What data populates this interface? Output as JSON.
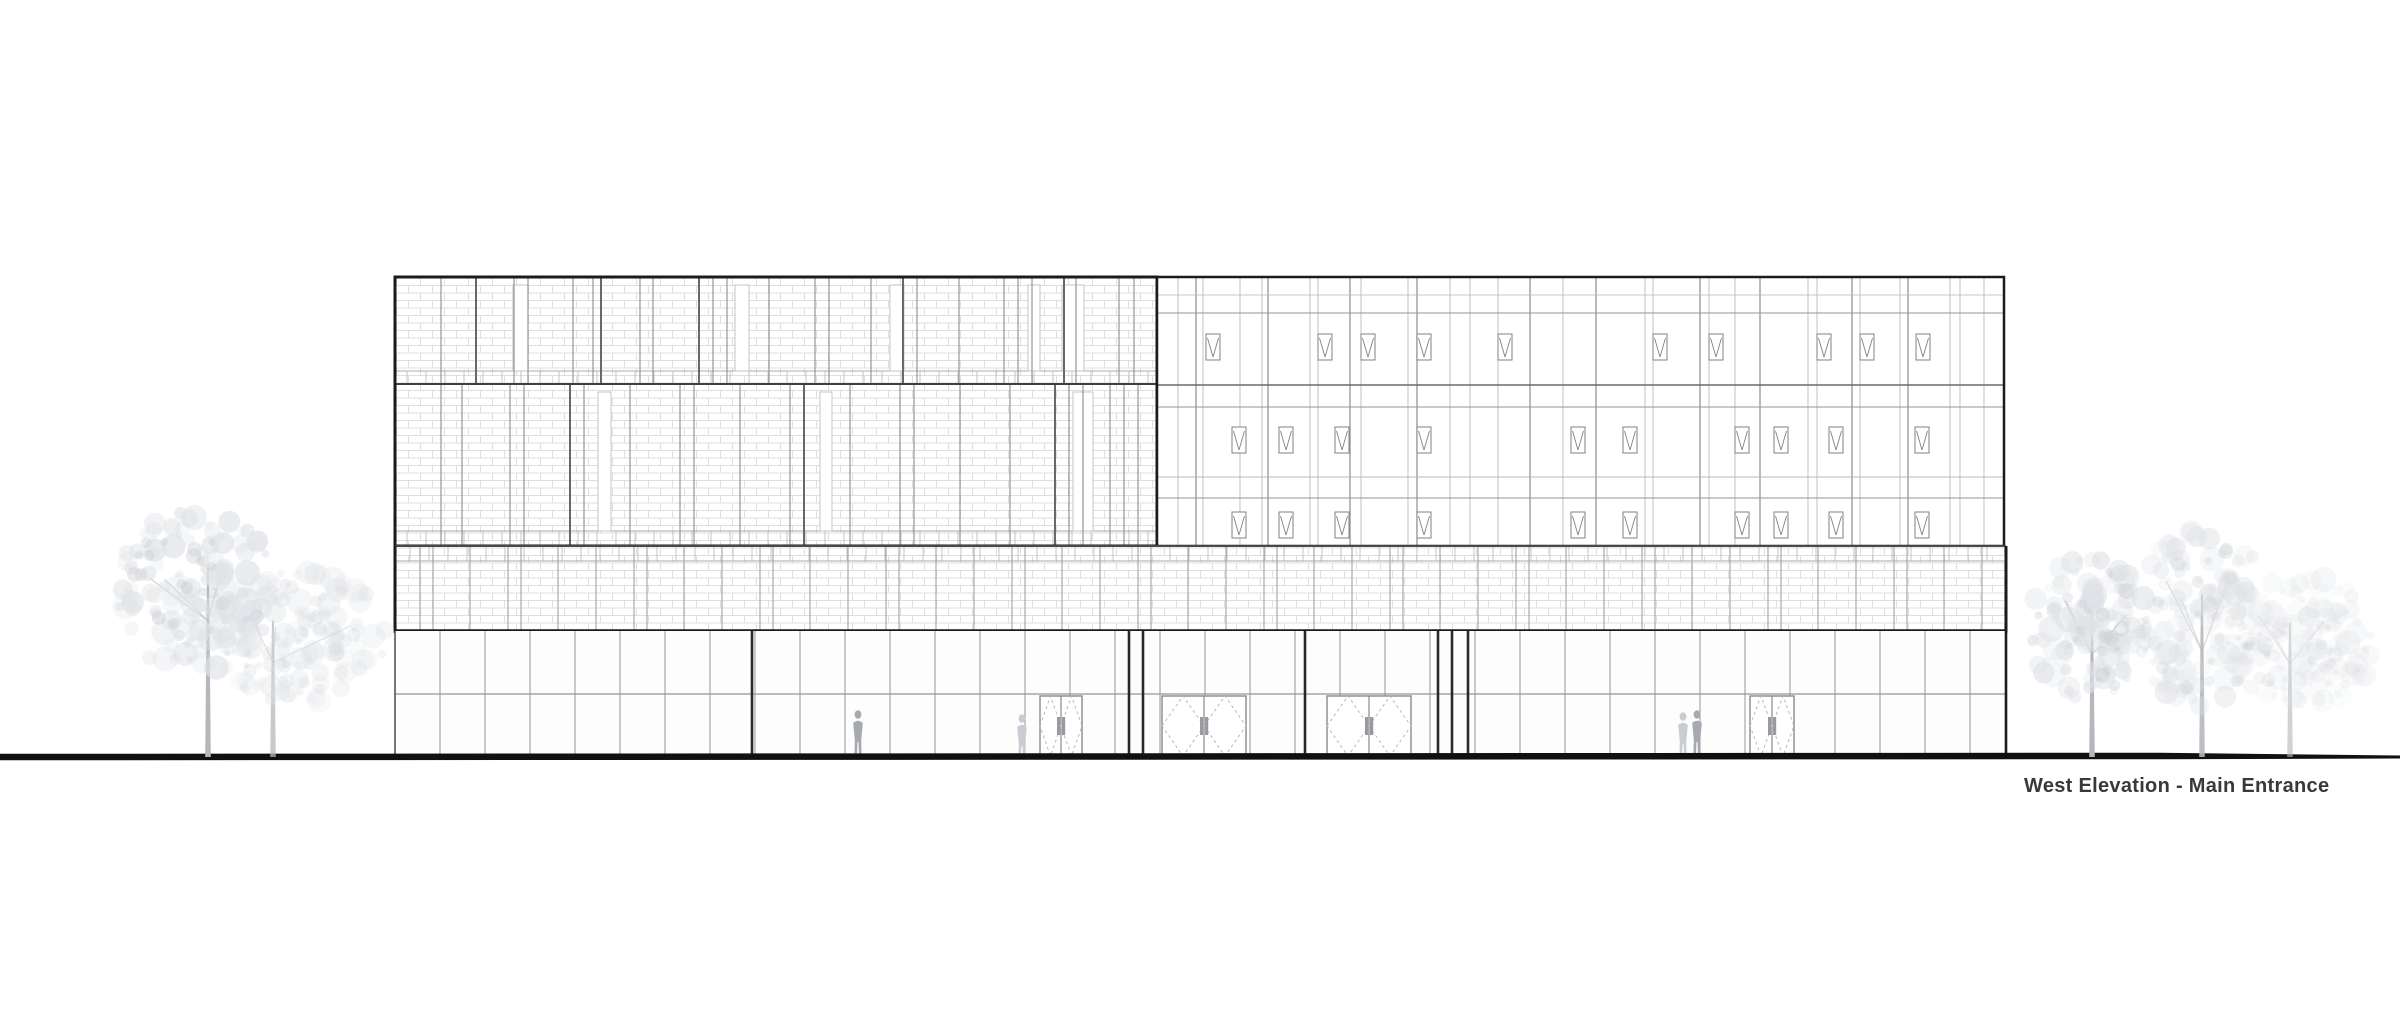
{
  "drawing": {
    "label": "West Elevation - Main Entrance"
  },
  "colors": {
    "background": "#ffffff",
    "outline": "#1b1b1d",
    "outline_medium": "#48484a",
    "mullion_dark": "#68686b",
    "mullion_mid": "#95959a",
    "mullion_light": "#b9b9bc",
    "brick_line": "#dfdfe2",
    "panel_fill": "#ffffff",
    "ground_line": "#101010",
    "label_text": "#39393b",
    "tree_foliage": "#dfe2e6",
    "tree_foliage_dark": "#c7cbd0",
    "tree_trunk": "#b4b7bc",
    "person_dark": "#a6aaaf",
    "person_light": "#c9cdd1"
  },
  "building": {
    "top": 277,
    "ground_y": 757,
    "left_block": {
      "x1": 395,
      "x2": 1157,
      "bands": [
        {
          "y1": 277,
          "y2": 384,
          "substrip_y": 371,
          "mullions": [
            441,
            476,
            514,
            528,
            573,
            593,
            601,
            640,
            653,
            699,
            713,
            727,
            769,
            815,
            829,
            871,
            903,
            917,
            959,
            1004,
            1018,
            1032,
            1064,
            1076,
            1119,
            1134
          ],
          "heavy": [
            476,
            601,
            699,
            903,
            1064
          ],
          "slots": [
            {
              "x": 513,
              "w": 15
            },
            {
              "x": 735,
              "w": 14
            },
            {
              "x": 890,
              "w": 14
            },
            {
              "x": 1028,
              "w": 12
            },
            {
              "x": 1062,
              "w": 22
            }
          ]
        },
        {
          "y1": 384,
          "y2": 546,
          "substrip_y": 531,
          "mullions": [
            441,
            462,
            510,
            524,
            570,
            584,
            630,
            680,
            694,
            740,
            790,
            804,
            850,
            900,
            914,
            960,
            1010,
            1055,
            1069,
            1083,
            1110,
            1124,
            1138
          ],
          "heavy": [
            570,
            804,
            1055
          ],
          "slots": [
            {
              "x": 598,
              "w": 13
            },
            {
              "x": 820,
              "w": 12
            },
            {
              "x": 1073,
              "w": 20
            }
          ]
        }
      ]
    },
    "right_block": {
      "x1": 1157,
      "x2": 2004,
      "rows": [
        {
          "y": 295,
          "w": 0.8,
          "tone": "light"
        },
        {
          "y": 313,
          "w": 1.0,
          "tone": "mid"
        },
        {
          "y": 385,
          "w": 1.6,
          "tone": "dark"
        },
        {
          "y": 407,
          "w": 1.0,
          "tone": "mid"
        },
        {
          "y": 477,
          "w": 0.9,
          "tone": "light"
        },
        {
          "y": 498,
          "w": 1.0,
          "tone": "mid"
        }
      ],
      "verticals": [
        1178,
        1196,
        1203,
        1240,
        1262,
        1268,
        1310,
        1318,
        1350,
        1361,
        1408,
        1417,
        1450,
        1470,
        1498,
        1530,
        1563,
        1596,
        1645,
        1653,
        1700,
        1709,
        1735,
        1760,
        1808,
        1817,
        1852,
        1860,
        1900,
        1908,
        1950,
        1960,
        1984
      ],
      "verticals_dark": [
        1196,
        1268,
        1350,
        1417,
        1530,
        1596,
        1700,
        1760,
        1852,
        1908
      ],
      "vent_w": 14,
      "vent_h": 26,
      "vent_rows": [
        {
          "y": 334,
          "xs": [
            1206,
            1318,
            1361,
            1417,
            1498,
            1653,
            1709,
            1817,
            1860,
            1916
          ]
        },
        {
          "y": 427,
          "xs": [
            1232,
            1279,
            1335,
            1417,
            1571,
            1623,
            1735,
            1774,
            1829,
            1915
          ]
        },
        {
          "y": 512,
          "xs": [
            1232,
            1279,
            1335,
            1417,
            1571,
            1623,
            1735,
            1774,
            1829,
            1915
          ]
        }
      ]
    },
    "mid_band": {
      "x1": 395,
      "x2": 2006,
      "y1": 546,
      "y2": 631,
      "strip_y": 561,
      "joints": [
        420,
        433,
        470,
        508,
        521,
        558,
        596,
        634,
        647,
        684,
        722,
        760,
        773,
        810,
        848,
        886,
        899,
        936,
        974,
        1012,
        1025,
        1062,
        1100,
        1138,
        1151,
        1188,
        1226,
        1264,
        1277,
        1314,
        1352,
        1390,
        1403,
        1440,
        1478,
        1516,
        1529,
        1566,
        1604,
        1642,
        1655,
        1692,
        1730,
        1768,
        1781,
        1818,
        1856,
        1894,
        1907,
        1944,
        1982
      ]
    },
    "ground_floor": {
      "x1": 395,
      "x2": 2006,
      "y1": 631,
      "y2": 757,
      "transom_y": 694,
      "mullion_spacing": 45,
      "heavy_x": [
        752,
        1129,
        1143,
        1305,
        1438,
        1452,
        1468
      ],
      "doors": [
        {
          "x": 1040,
          "w": 42
        },
        {
          "x": 1162,
          "w": 84
        },
        {
          "x": 1327,
          "w": 84
        },
        {
          "x": 1750,
          "w": 44
        }
      ]
    }
  },
  "people": [
    {
      "x": 858,
      "h": 46,
      "tone": "dark"
    },
    {
      "x": 1022,
      "h": 42,
      "tone": "light"
    },
    {
      "x": 1683,
      "h": 44,
      "tone": "light"
    },
    {
      "x": 1697,
      "h": 46,
      "tone": "dark"
    }
  ],
  "trees": [
    {
      "cx": 195,
      "cy": 590,
      "rx": 78,
      "ry": 88,
      "trunkX": 208,
      "seed": 11,
      "opacity": 0.9
    },
    {
      "cx": 300,
      "cy": 638,
      "rx": 90,
      "ry": 70,
      "trunkX": 273,
      "seed": 22,
      "opacity": 0.55
    },
    {
      "cx": 2090,
      "cy": 628,
      "rx": 62,
      "ry": 76,
      "trunkX": 2092,
      "seed": 33,
      "opacity": 0.85
    },
    {
      "cx": 2203,
      "cy": 618,
      "rx": 70,
      "ry": 95,
      "trunkX": 2202,
      "seed": 44,
      "opacity": 0.7
    },
    {
      "cx": 2300,
      "cy": 640,
      "rx": 78,
      "ry": 68,
      "trunkX": 2290,
      "seed": 55,
      "opacity": 0.42
    }
  ],
  "ground": {
    "y": 757,
    "thick_x1": 0,
    "thick_x2": 2160,
    "thick_w": 6.5,
    "thin_x2": 2400,
    "thin_w": 3
  }
}
